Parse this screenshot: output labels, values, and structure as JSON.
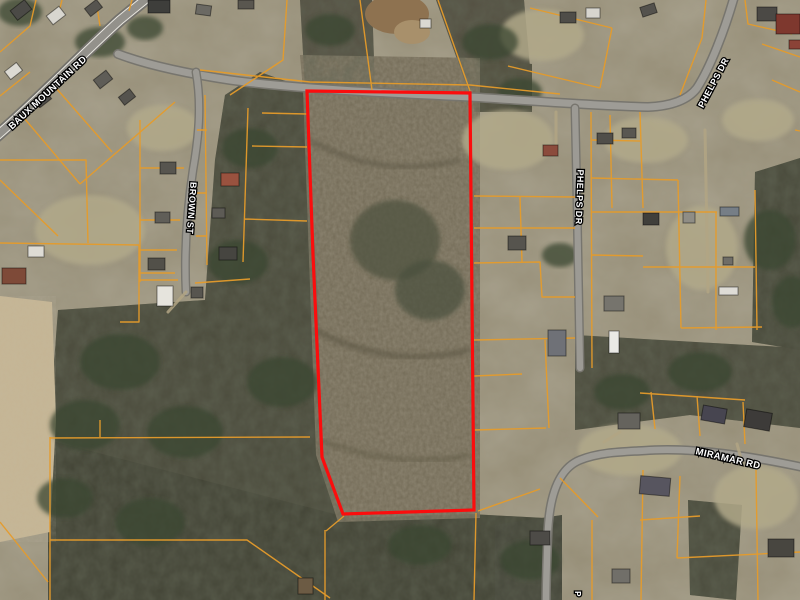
{
  "map": {
    "description": "Aerial parcel map with highlighted property boundary",
    "colors": {
      "parcel_lines": "#e59b2b",
      "highlight": "#fb0d0d",
      "label_text": "#ffffff",
      "label_halo": "#000000",
      "road_fill": "#9e9c96"
    },
    "road_labels": [
      {
        "id": "baux-mountain-rd",
        "text": "BAUX MOUNTAIN RD",
        "x": 48,
        "y": 93,
        "rotation": -43,
        "size": 9.5
      },
      {
        "id": "brown-st",
        "text": "BROWN ST",
        "x": 191,
        "y": 208,
        "rotation": 94,
        "size": 9
      },
      {
        "id": "phelps-dr-center",
        "text": "PHELPS DR",
        "x": 579,
        "y": 197,
        "rotation": 92,
        "size": 9
      },
      {
        "id": "phelps-dr-north",
        "text": "PHELPS DR",
        "x": 714,
        "y": 83,
        "rotation": -62,
        "size": 9
      },
      {
        "id": "miramar-rd",
        "text": "MIRAMAR RD",
        "x": 728,
        "y": 459,
        "rotation": 13,
        "size": 9.5
      },
      {
        "id": "partial-bottom",
        "text": "P",
        "x": 577,
        "y": 594,
        "rotation": 90,
        "size": 8
      }
    ],
    "highlighted_parcel": {
      "points": "307,91 470,93 474,510 343,514 322,457 313,255",
      "stroke_width": 3.2
    }
  }
}
